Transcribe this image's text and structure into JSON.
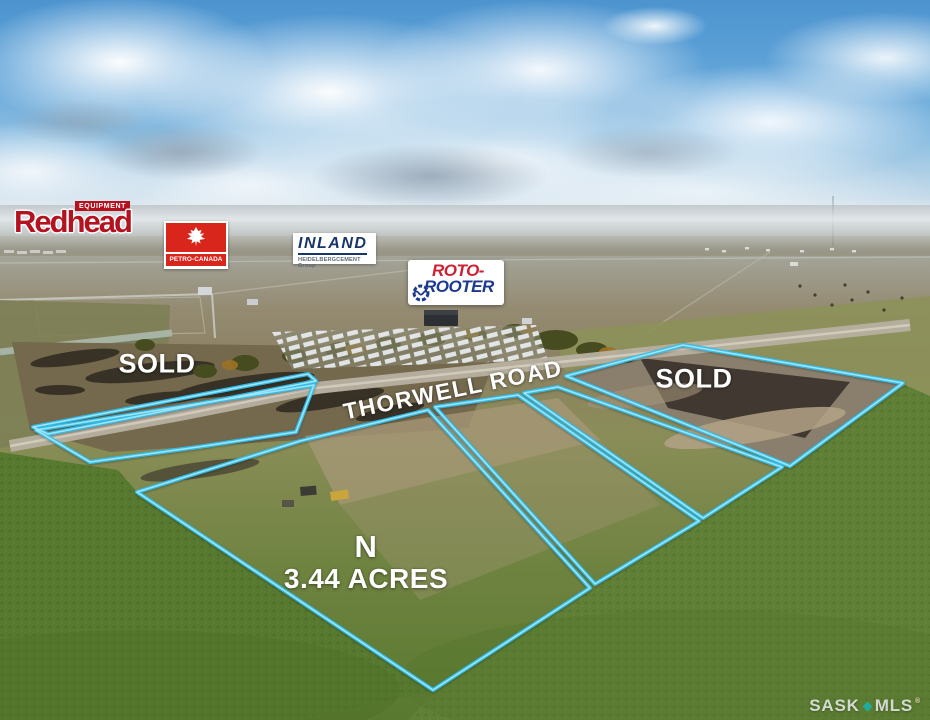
{
  "colors": {
    "parcel_outline": "#2fbfec",
    "parcel_outline_core": "#aeeafc",
    "label_white": "#ffffff",
    "redhead_red": "#b5121f",
    "petro_red": "#d9261c",
    "inland_navy": "#17356b",
    "roto_red": "#ce2030",
    "roto_blue": "#1c3a8f",
    "watermark_teal": "#19b1a6"
  },
  "logos": {
    "redhead": {
      "name": "Redhead",
      "badge": "EQUIPMENT"
    },
    "petro": {
      "wordmark": "PETRO-CANADA"
    },
    "inland": {
      "wordmark": "INLAND",
      "subtext": "HEIDELBERGCEMENT Group"
    },
    "roto": {
      "line1": "ROTO-",
      "line2": "ROOTER"
    }
  },
  "labels": {
    "sold_left": "SOLD",
    "sold_right": "SOLD",
    "road": "THORWELL ROAD",
    "north": "N",
    "acreage": "3.44 ACRES"
  },
  "watermark": {
    "sask": "SASK",
    "mls": "MLS",
    "reg": "®"
  }
}
